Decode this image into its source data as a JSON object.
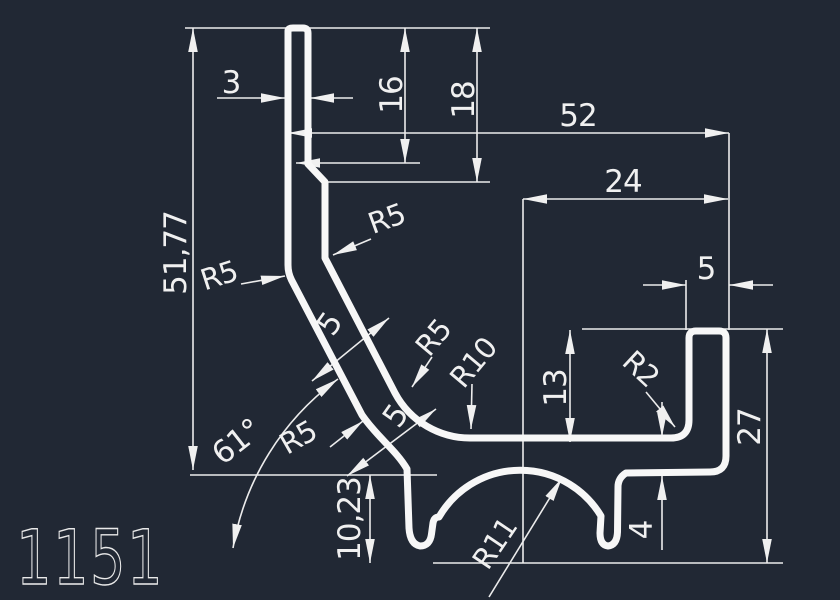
{
  "canvas": {
    "background": "#212834",
    "line_color": "#f2f2f2"
  },
  "title_block": {
    "part_number": "1151"
  },
  "dimensions": {
    "fin_thickness": "3",
    "upper_step_height": "16",
    "lower_step_height": "18",
    "overall_width": "52",
    "channel_center_offset": "24",
    "rim_width": "5",
    "total_height": "51,77",
    "channel_depth": "13",
    "right_height": "27",
    "base_thickness": "4",
    "foot_height": "10,23",
    "wall_angle": "61°",
    "wall_thickness_upper": "5",
    "wall_thickness_lower": "5"
  },
  "radii": {
    "r5_top": "R5",
    "r5_left": "R5",
    "r5_mid": "R5",
    "r5_bottom": "R5",
    "r10": "R10",
    "r2": "R2",
    "r11": "R11"
  }
}
